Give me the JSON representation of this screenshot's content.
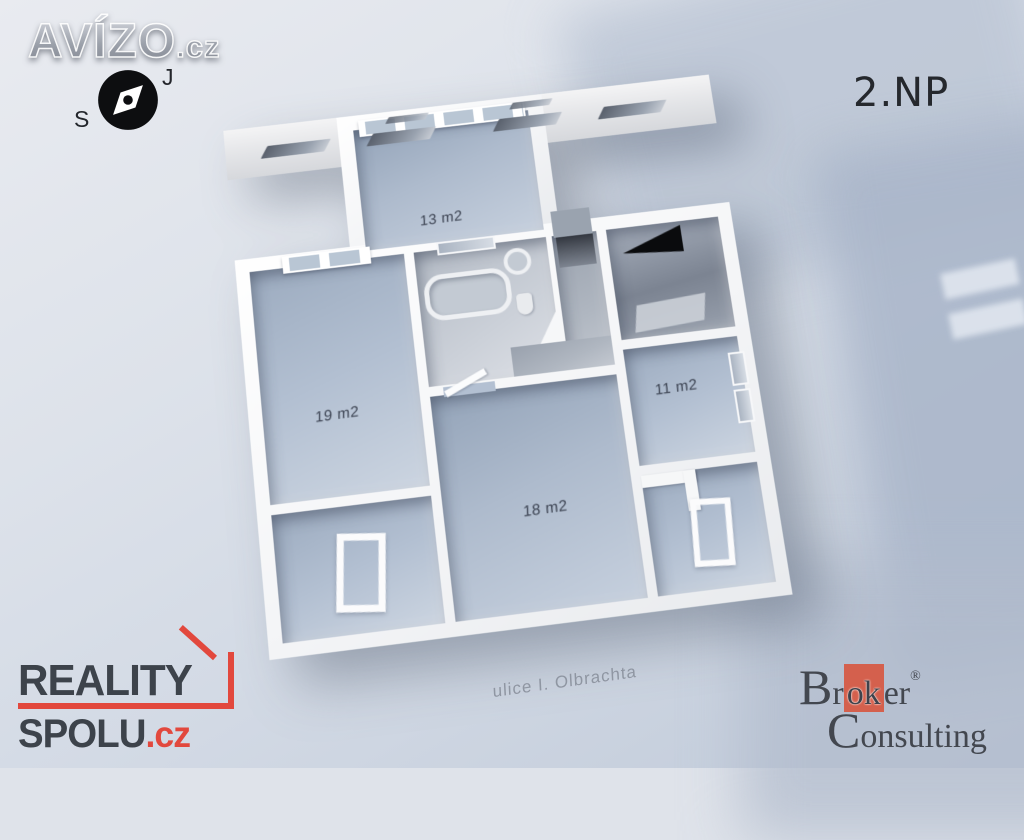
{
  "scene": {
    "floor_label": "2.NP",
    "street_label": "ulice I. Olbrachta"
  },
  "floorplan": {
    "rooms": [
      {
        "name": "top-room",
        "area_label": "13 m2"
      },
      {
        "name": "left-room",
        "area_label": "19 m2"
      },
      {
        "name": "center-room",
        "area_label": "18 m2"
      },
      {
        "name": "right-room",
        "area_label": "11 m2"
      }
    ],
    "features": [
      "bathroom with bathtub, sink and toilet",
      "hallway",
      "staircase void",
      "floor hatches",
      "facade window slits"
    ]
  },
  "branding": {
    "avizo": {
      "text": "AVÍZO",
      "suffix": ".cz"
    },
    "compass": {
      "top_label": "J",
      "bottom_label": "S"
    },
    "reality_spolu": {
      "line1": "REALITY",
      "line2": "SPOLU",
      "suffix": ".cz"
    },
    "broker": {
      "part1": "Br",
      "highlight": "ok",
      "part2": "er",
      "registered": "®",
      "line2": "Consulting"
    }
  },
  "colors": {
    "background_top": "#e9ebf0",
    "background_bottom": "#c0cad9",
    "wall_white": "#f4f5f7",
    "floor_blue_gray": "#aebbcd",
    "accent_red": "#e2483d",
    "broker_red": "#d4604d",
    "label_dark": "#3a4150"
  }
}
